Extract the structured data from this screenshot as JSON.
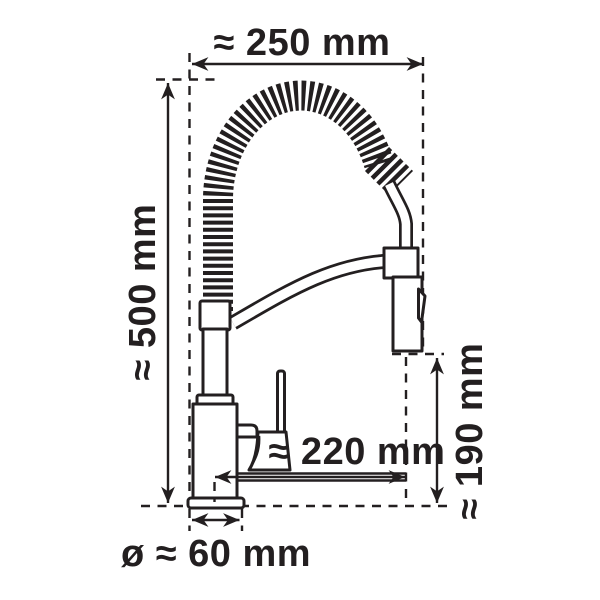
{
  "figure": {
    "colors": {
      "ink": "#231f20",
      "background": "#ffffff"
    },
    "dimensions": {
      "overall_width": "≈ 250 mm",
      "overall_height": "≈ 500 mm",
      "spout_reach": "≈ 220 mm",
      "outlet_clearance": "≈ 190 mm",
      "base_diameter": "ø ≈ 60 mm"
    }
  }
}
